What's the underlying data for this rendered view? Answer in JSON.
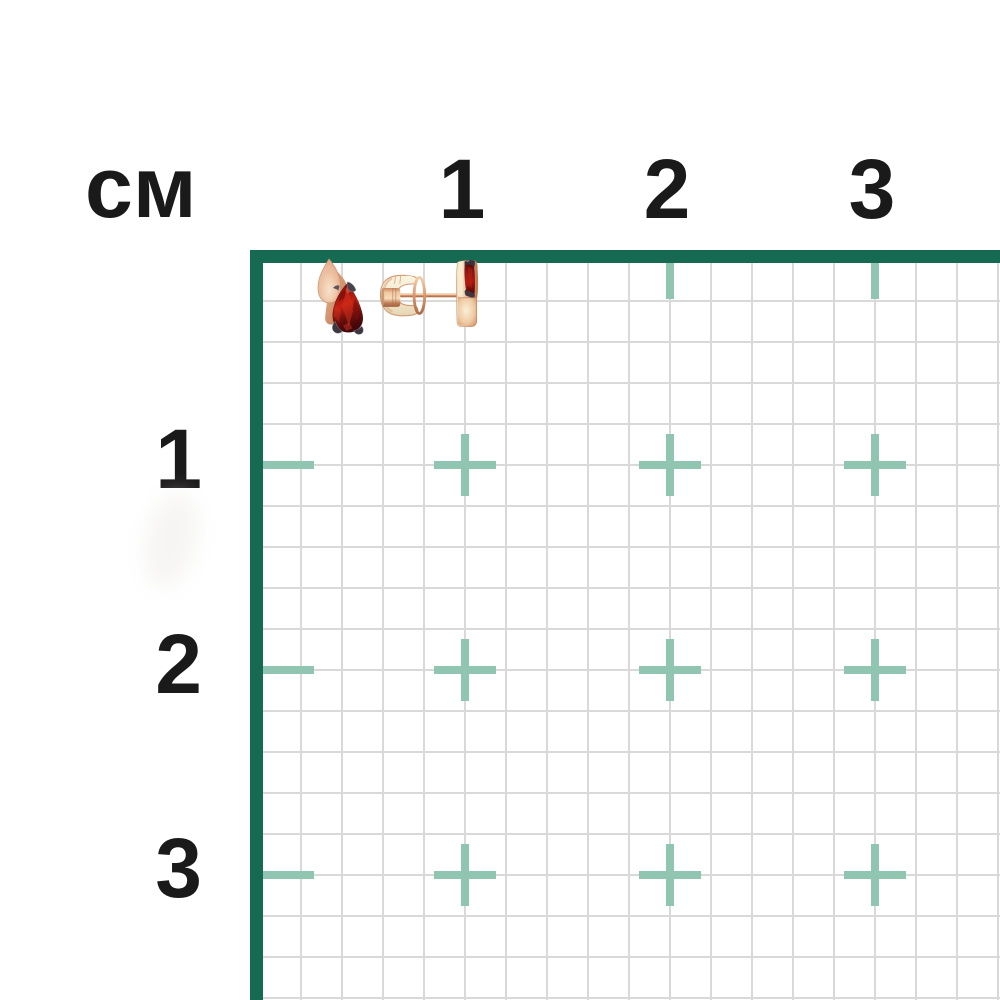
{
  "ruler": {
    "unit_label": "см",
    "top_labels": [
      "1",
      "2",
      "3"
    ],
    "left_labels": [
      "1",
      "2",
      "3"
    ],
    "cm_px": 205,
    "minor_cells_per_cm": 5,
    "colors": {
      "frame": "#176A52",
      "minor_grid": "#D9D9D9",
      "major_mark": "#8FC5B1",
      "label_text": "#1B1A1A"
    }
  },
  "product": {
    "name": "Gold stud earring with pear-cut garnet, front view and side view with clutch back",
    "colors": {
      "rose_gold": "#E2A886",
      "rose_gold_highlight": "#F8EFD9",
      "rose_gold_shadow": "#B06C4A",
      "cream_gold": "#F5EDD6",
      "garnet_red": "#B01A12",
      "garnet_dark": "#4A0609",
      "garnet_bright": "#D73A1A",
      "prong_metal": "#3D3741"
    }
  }
}
